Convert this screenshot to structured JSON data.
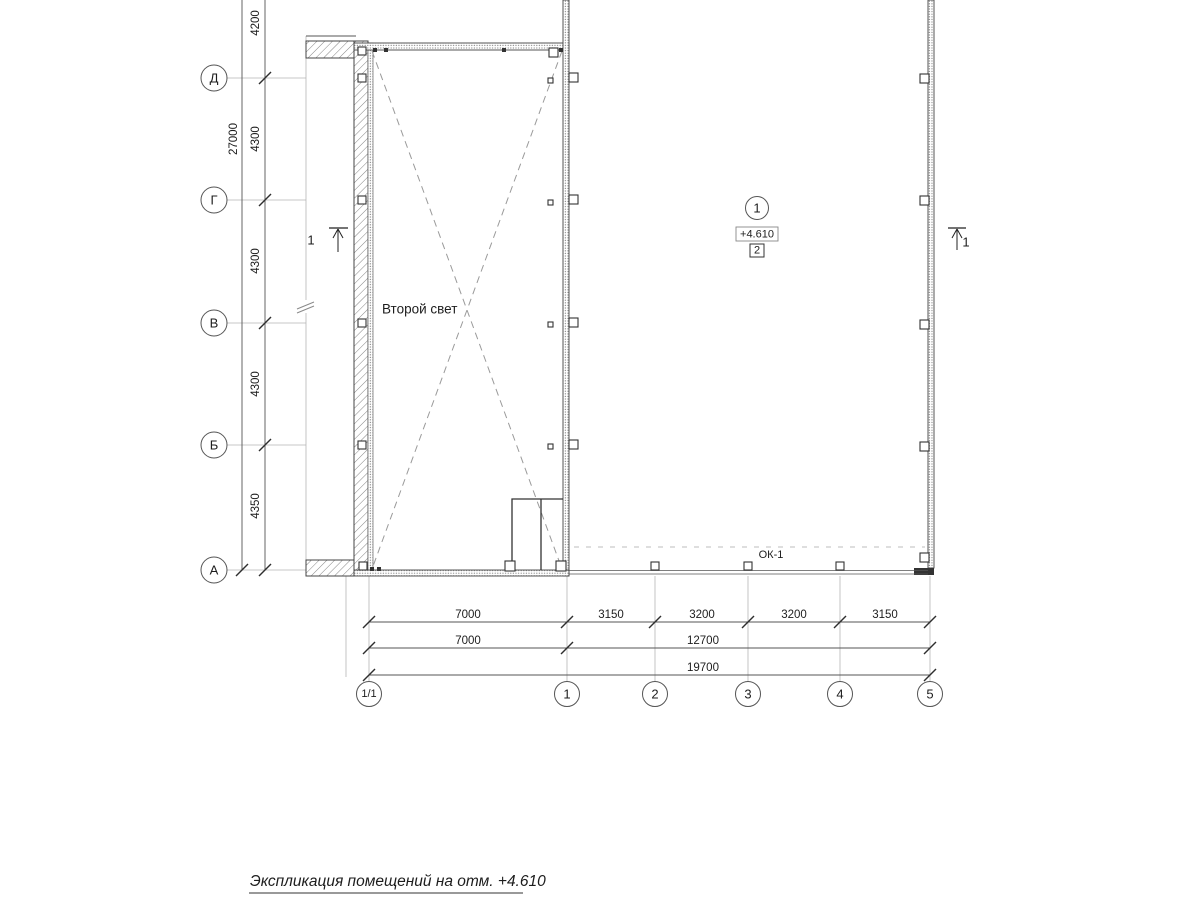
{
  "drawing": {
    "title": "Экспликация помещений на отм. +4.610",
    "room_label": "Второй свет",
    "window_mark": "ОК-1",
    "section_mark_left": "1",
    "section_mark_right": "1",
    "room_tag": {
      "number": "1",
      "elevation": "+4.610",
      "index": "2"
    }
  },
  "grid": {
    "left_axes": [
      "Д",
      "Г",
      "В",
      "Б",
      "А"
    ],
    "bottom_axes": [
      "1/1",
      "1",
      "2",
      "3",
      "4",
      "5"
    ]
  },
  "dimensions": {
    "vertical": {
      "overall": "27000",
      "segments": [
        "4200",
        "4300",
        "4300",
        "4300",
        "4350"
      ]
    },
    "horizontal": {
      "row1": [
        "7000",
        "3150",
        "3200",
        "3200",
        "3150"
      ],
      "row2": [
        "7000",
        "12700"
      ],
      "row3": [
        "19700"
      ]
    }
  },
  "colors": {
    "line": "#333333",
    "wall_edge": "#444444",
    "light_line": "#aaaaaa",
    "dashed": "#999999",
    "background": "#ffffff"
  }
}
